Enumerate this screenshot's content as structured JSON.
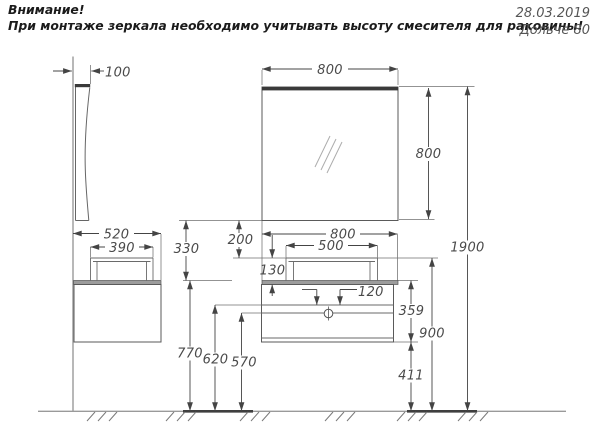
{
  "note": {
    "title": "Внимание!",
    "body": "При монтаже зеркала необходимо учитывать высоту смесителя для раковины!"
  },
  "stamp": {
    "date": "28.03.2019",
    "model": "Дольче 80"
  },
  "dims": {
    "mirror_depth": "100",
    "mirror_width": "800",
    "mirror_height": "800",
    "total_height": "1900",
    "cabinet_depth": "520",
    "sink_depth": "390",
    "mirror_to_counter": "330",
    "mirror_to_sink": "200",
    "vanity_width": "800",
    "sink_width": "500",
    "sink_height": "130",
    "drain_offset": "120",
    "counter_height": "770",
    "drain_height_upper": "620",
    "drain_height_lower": "570",
    "sink_top_height": "900",
    "cabinet_height": "359",
    "bottom_clearance": "411"
  },
  "colors": {
    "background": "#ffffff",
    "object_line": "#666666",
    "dimension_line": "#444444",
    "dimension_text": "#4a4a4a",
    "note_text": "#1b1b1b",
    "stamp_text": "#555555",
    "dark_fill": "#3a3a3a",
    "counter_fill": "#9c9c9c"
  }
}
